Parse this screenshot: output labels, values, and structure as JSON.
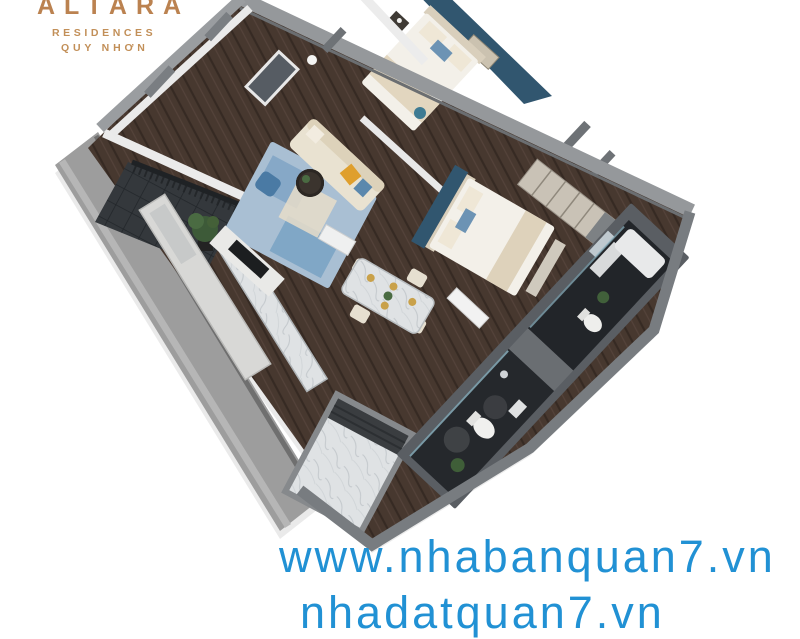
{
  "branding": {
    "name": "ALTARA",
    "sub1": "RESIDENCES",
    "sub2": "QUY NHƠN",
    "gold": "#bb8250"
  },
  "watermark": {
    "line1": "www.nhabanquan7.vn",
    "line2": "nhadatquan7.vn",
    "blue": "#2191d4"
  },
  "colors": {
    "accent_blue": "#31566f",
    "rug_blue": "#a9bfd3",
    "wood_floor": "#47382f",
    "bath_dark": "#25282c",
    "wall_gray": "#95989b",
    "marble": "#dfe2e4",
    "sofa_cream": "#e9e2d1",
    "pillow_orange": "#df9f2d",
    "pouf_blue": "#4a7aa4",
    "plant_green": "#3d5a38",
    "rail_black": "#1f2225"
  },
  "scene": {
    "type": "3d-apartment-floorplan",
    "rooms": [
      "living-room",
      "bedroom-1",
      "bedroom-2",
      "bathroom-1",
      "bathroom-2",
      "kitchen",
      "dining-area",
      "balcony",
      "entry-foyer"
    ]
  }
}
